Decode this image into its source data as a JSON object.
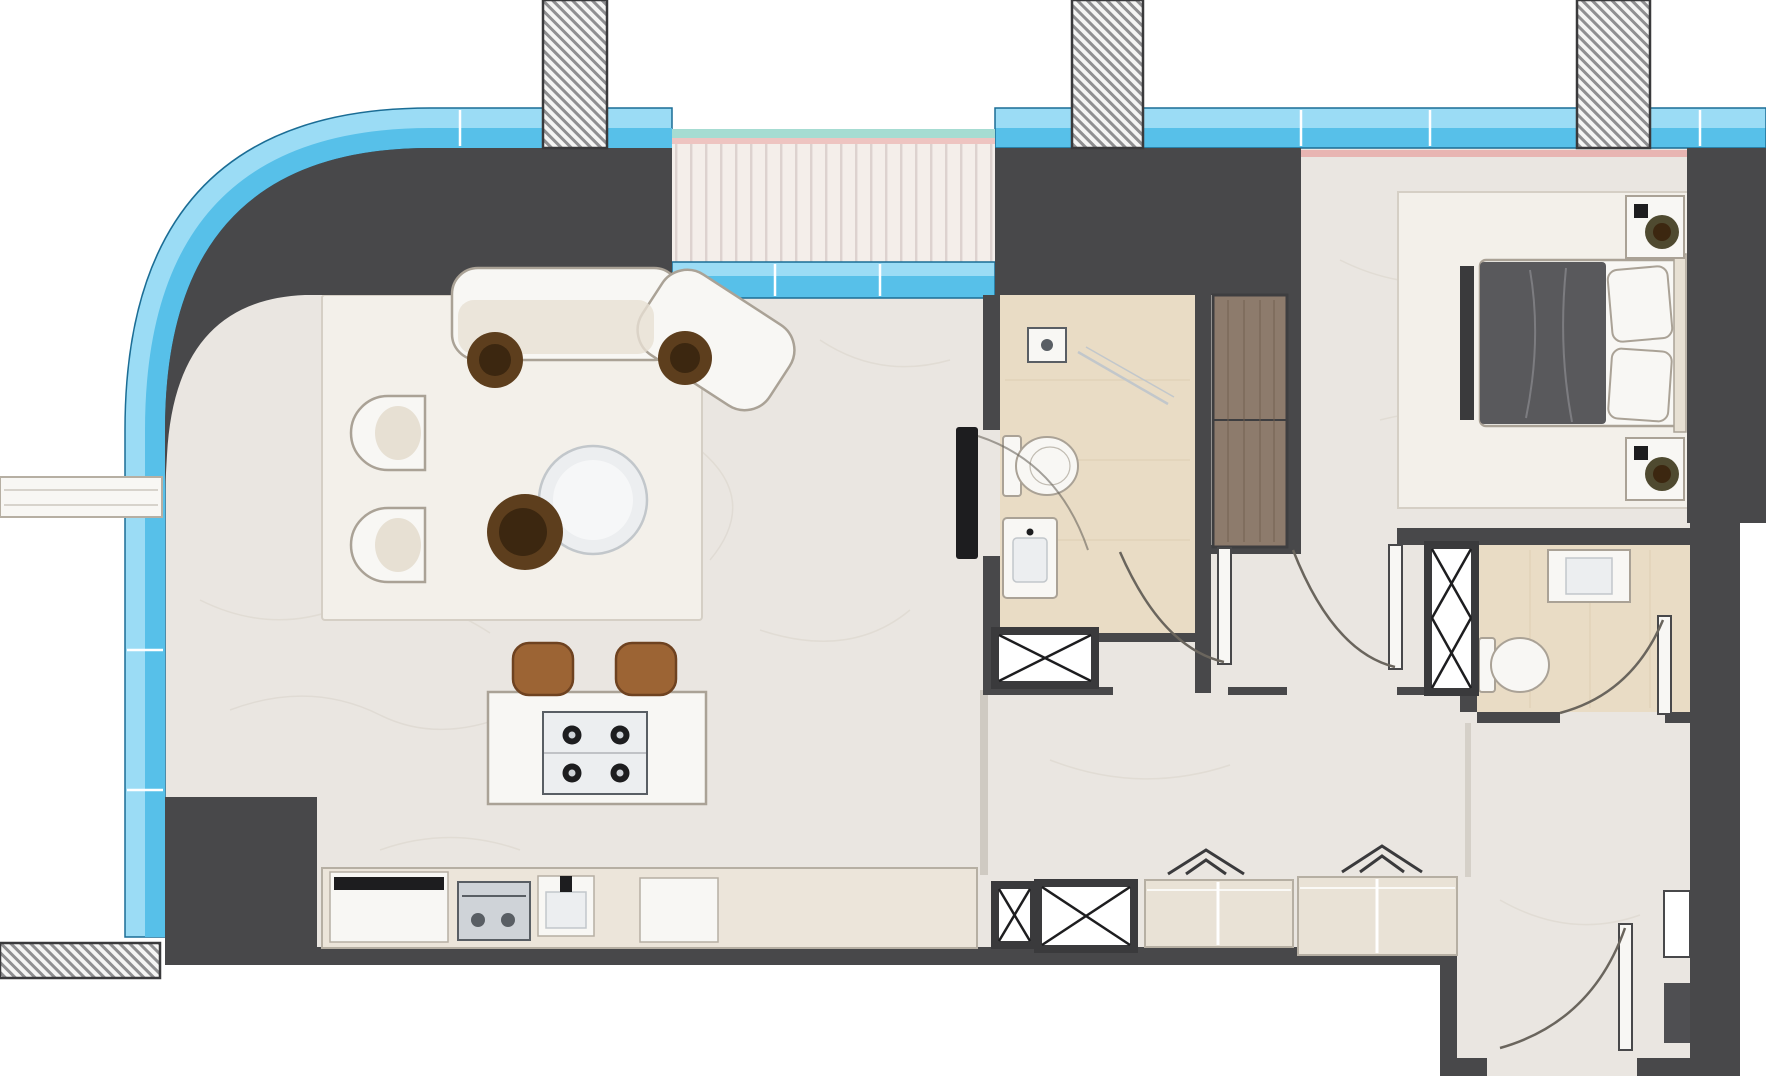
{
  "meta": {
    "title": "Apartment floor plan",
    "type": "architectural-floor-plan",
    "view": "top-down",
    "text_labels_visible": "none"
  },
  "rooms": [
    {
      "id": "living-dining",
      "name": "living-dining-area"
    },
    {
      "id": "kitchen",
      "name": "kitchen"
    },
    {
      "id": "balcony",
      "name": "balcony"
    },
    {
      "id": "bathroom-1",
      "name": "bathroom-1"
    },
    {
      "id": "bathroom-2",
      "name": "bathroom-2"
    },
    {
      "id": "bedroom",
      "name": "bedroom"
    },
    {
      "id": "dressing-area",
      "name": "dressing-area"
    },
    {
      "id": "entry-hall",
      "name": "entry-hall"
    }
  ],
  "structure": {
    "hatched_columns": 4,
    "duct_shafts": 4,
    "door_swings": 5,
    "glazing": "light-blue curtain wall with curved top-left corner"
  },
  "colors": {
    "wall": "#48484a",
    "wall_dark": "#3a3a3c",
    "glazing_light": "#9bdcf5",
    "glazing_mid": "#57c0e9",
    "glazing_edge": "#1b6d95",
    "deck": "#f4eeea",
    "deck_stripe": "#ddd2cf",
    "deck_teal": "#a6dcd2",
    "deck_pink": "#eec4c1",
    "curtain_pink": "#e8b5b2",
    "floor": "#eae6e1",
    "floor_vein": "#d9d3cb",
    "rug": "#f3f0ea",
    "rug_edge": "#d5cfc5",
    "bath_floor": "#e9dcc5",
    "bath_line": "#d9c9ad",
    "counter": "#ece5da",
    "counter_stroke": "#b6afa3",
    "cabinet": "#e9e2d6",
    "white": "#f8f7f4",
    "furniture_stroke": "#aaa296",
    "seat": "#e7e0d3",
    "table": "#eceef0",
    "table_stroke": "#c2c7cb",
    "wood": "#8d7b6c",
    "wood_grain": "#6f5e4e",
    "wood_frame": "#3e3e40",
    "plant_dark": "#3c2710",
    "plant_mid": "#5d3e1d",
    "plant_olive": "#4f4a30",
    "stool": "#9c6434",
    "stool_dark": "#6e4220",
    "blanket": "#59595c",
    "blanket_fold": "#7c7c80",
    "black": "#1d1d1f",
    "hatch_line": "#8f8f91",
    "hatch_bg": "#f5f5f4",
    "arc_stroke": "#6a655d",
    "steel": "#cfd3d8",
    "steel_dark": "#595e64",
    "seam": "#cfcac2",
    "recess_dark": "#4f4f52"
  }
}
